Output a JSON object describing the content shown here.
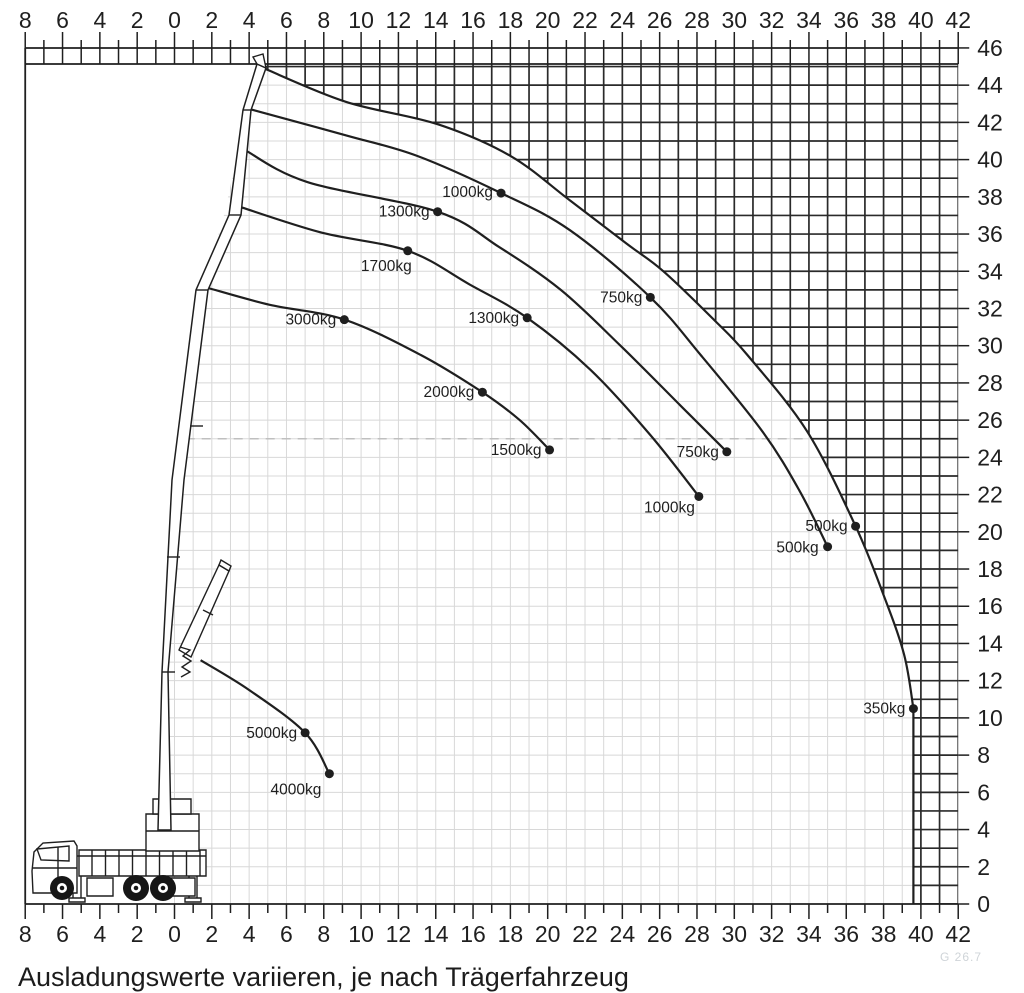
{
  "caption": "Ausladungswerte variieren, je nach Trägerfahrzeug",
  "corner_note": "G 26.7",
  "colors": {
    "background": "#ffffff",
    "ink": "#1f1f1f",
    "grid_light": "#d8d8d8",
    "grid_dark": "#2a2a2a",
    "dashed_guide": "#bfbfbf",
    "watermark": "#cfd4d8"
  },
  "chart_data": {
    "type": "line",
    "title": "",
    "xlabel": "outreach (m)",
    "ylabel": "height (m)",
    "x_axis": {
      "min": -8,
      "max": 42,
      "minor_step": 1,
      "label_step": 2,
      "abs_labels": true,
      "shown": "top and bottom"
    },
    "y_axis": {
      "min": 0,
      "max": 46,
      "minor_step": 1,
      "label_step": 2,
      "side": "right"
    },
    "grid": "on",
    "dashed_guide": {
      "y": 25,
      "x_from": 0.6,
      "x_to": 33.8
    },
    "curves": [
      {
        "name": "envelope-max-boom",
        "drop_to_ground": true,
        "points": [
          [
            4.8,
            44.9
          ],
          [
            9.2,
            43.1
          ],
          [
            14.1,
            41.9
          ],
          [
            18.0,
            40.2
          ],
          [
            21.2,
            37.8
          ],
          [
            24.2,
            35.5
          ],
          [
            26.2,
            34.0
          ],
          [
            28.9,
            31.4
          ],
          [
            30.7,
            29.5
          ],
          [
            33.9,
            25.4
          ],
          [
            36.5,
            20.3
          ],
          [
            38.0,
            16.6
          ],
          [
            39.1,
            13.4
          ],
          [
            39.6,
            10.5
          ]
        ],
        "marks": [
          {
            "label": "500kg",
            "x": 36.5,
            "y": 20.3,
            "dx": -8,
            "dy": 5
          },
          {
            "label": "350kg",
            "x": 39.6,
            "y": 10.5,
            "dx": -8,
            "dy": 5
          }
        ]
      },
      {
        "name": "curve-2",
        "points": [
          [
            4.1,
            42.7
          ],
          [
            9.2,
            41.3
          ],
          [
            13.0,
            40.2
          ],
          [
            17.5,
            38.2
          ],
          [
            21.2,
            36.2
          ],
          [
            25.5,
            32.6
          ],
          [
            28.2,
            29.5
          ],
          [
            31.5,
            25.4
          ],
          [
            33.5,
            22.2
          ],
          [
            35.0,
            19.2
          ]
        ],
        "marks": [
          {
            "label": "1000kg",
            "x": 17.5,
            "y": 38.2,
            "dx": -8,
            "dy": 4
          },
          {
            "label": "750kg",
            "x": 25.5,
            "y": 32.6,
            "dx": -8,
            "dy": 5
          },
          {
            "label": "500kg",
            "x": 35.0,
            "y": 19.2,
            "dx": -9,
            "dy": 6
          }
        ]
      },
      {
        "name": "curve-3",
        "points": [
          [
            3.8,
            40.5
          ],
          [
            7.1,
            38.8
          ],
          [
            14.1,
            37.2
          ],
          [
            17.4,
            35.3
          ],
          [
            20.7,
            33.0
          ],
          [
            23.9,
            30.0
          ],
          [
            27.1,
            26.8
          ],
          [
            29.6,
            24.3
          ]
        ],
        "marks": [
          {
            "label": "1300kg",
            "x": 14.1,
            "y": 37.2,
            "dx": -8,
            "dy": 5
          },
          {
            "label": "750kg",
            "x": 29.6,
            "y": 24.3,
            "dx": -8,
            "dy": 5
          }
        ]
      },
      {
        "name": "curve-4",
        "points": [
          [
            3.1,
            37.6
          ],
          [
            7.8,
            36.1
          ],
          [
            12.5,
            35.1
          ],
          [
            15.8,
            33.3
          ],
          [
            18.9,
            31.5
          ],
          [
            22.3,
            28.7
          ],
          [
            25.5,
            25.2
          ],
          [
            28.1,
            21.9
          ]
        ],
        "marks": [
          {
            "label": "1700kg",
            "x": 12.5,
            "y": 35.1,
            "dx": 4,
            "dy": 20
          },
          {
            "label": "1300kg",
            "x": 18.9,
            "y": 31.5,
            "dx": -8,
            "dy": 5
          },
          {
            "label": "1000kg",
            "x": 28.1,
            "y": 21.9,
            "dx": -4,
            "dy": 16
          }
        ]
      },
      {
        "name": "curve-5",
        "points": [
          [
            1.8,
            33.1
          ],
          [
            5.1,
            32.2
          ],
          [
            9.1,
            31.4
          ],
          [
            13.2,
            29.5
          ],
          [
            16.5,
            27.5
          ],
          [
            18.5,
            26.0
          ],
          [
            20.1,
            24.4
          ]
        ],
        "marks": [
          {
            "label": "3000kg",
            "x": 9.1,
            "y": 31.4,
            "dx": -8,
            "dy": 5
          },
          {
            "label": "2000kg",
            "x": 16.5,
            "y": 27.5,
            "dx": -8,
            "dy": 5
          },
          {
            "label": "1500kg",
            "x": 20.1,
            "y": 24.4,
            "dx": -8,
            "dy": 5
          }
        ]
      },
      {
        "name": "curve-folded-boom",
        "points": [
          [
            1.4,
            13.1
          ],
          [
            4.0,
            11.5
          ],
          [
            7.0,
            9.2
          ],
          [
            8.3,
            7.0
          ]
        ],
        "marks": [
          {
            "label": "5000kg",
            "x": 7.0,
            "y": 9.2,
            "dx": -8,
            "dy": 5
          },
          {
            "label": "4000kg",
            "x": 8.3,
            "y": 7.0,
            "dx": -8,
            "dy": 21
          }
        ]
      }
    ]
  }
}
